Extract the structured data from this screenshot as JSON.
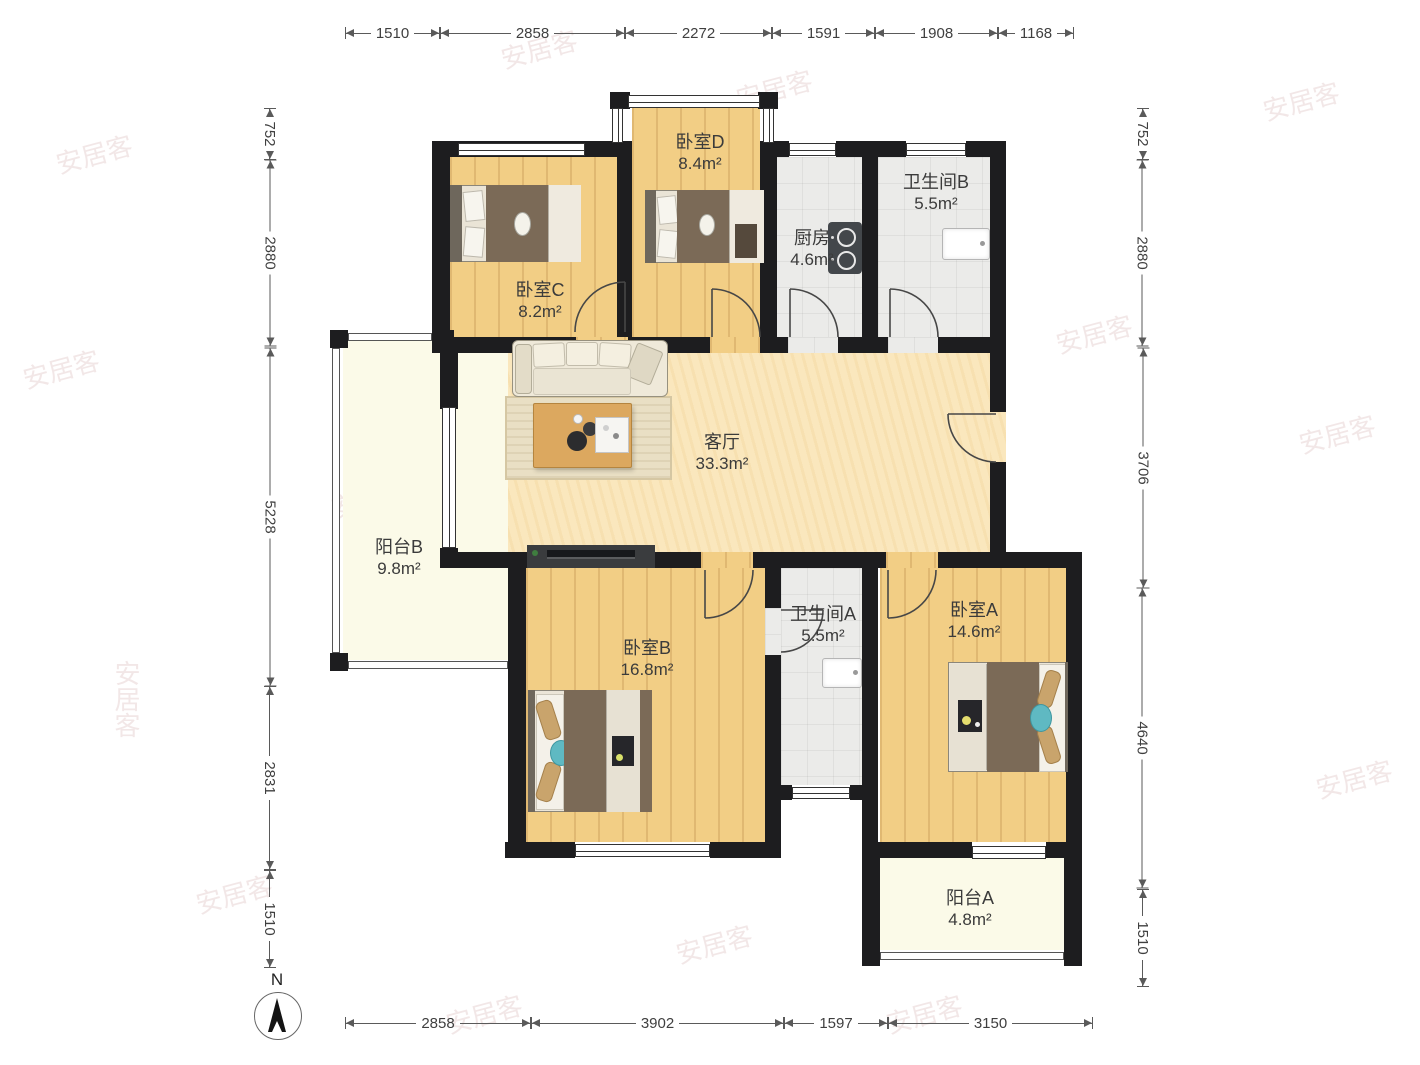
{
  "watermark": {
    "text": "安居客"
  },
  "compass": {
    "north_label": "N"
  },
  "rooms": [
    {
      "id": "bedroom-d",
      "name": "卧室D",
      "area": "8.4m²"
    },
    {
      "id": "bathroom-b",
      "name": "卫生间B",
      "area": "5.5m²"
    },
    {
      "id": "kitchen",
      "name": "厨房",
      "area": "4.6m²"
    },
    {
      "id": "bedroom-c",
      "name": "卧室C",
      "area": "8.2m²"
    },
    {
      "id": "living-room",
      "name": "客厅",
      "area": "33.3m²"
    },
    {
      "id": "balcony-b",
      "name": "阳台B",
      "area": "9.8m²"
    },
    {
      "id": "bedroom-b",
      "name": "卧室B",
      "area": "16.8m²"
    },
    {
      "id": "bathroom-a",
      "name": "卫生间A",
      "area": "5.5m²"
    },
    {
      "id": "bedroom-a",
      "name": "卧室A",
      "area": "14.6m²"
    },
    {
      "id": "balcony-a",
      "name": "阳台A",
      "area": "4.8m²"
    }
  ],
  "dimensions": {
    "top": [
      "1510",
      "2858",
      "2272",
      "1591",
      "1908",
      "1168"
    ],
    "bottom": [
      "2858",
      "3902",
      "1597",
      "3150"
    ],
    "left": [
      "752",
      "2880",
      "5228",
      "2831",
      "1510"
    ],
    "right": [
      "752",
      "2880",
      "3706",
      "4640",
      "1510"
    ]
  },
  "colors": {
    "wall": "#1d1d1f",
    "wood_floor": "#F2CE85",
    "living_floor": "#FAE7BD",
    "tile_floor": "#EBEBE9",
    "balcony_floor": "#FBFAE8",
    "duvet_brown": "#7B6A57",
    "pillow_tan": "#C9A46C",
    "accent_teal": "#5FB9C2"
  }
}
